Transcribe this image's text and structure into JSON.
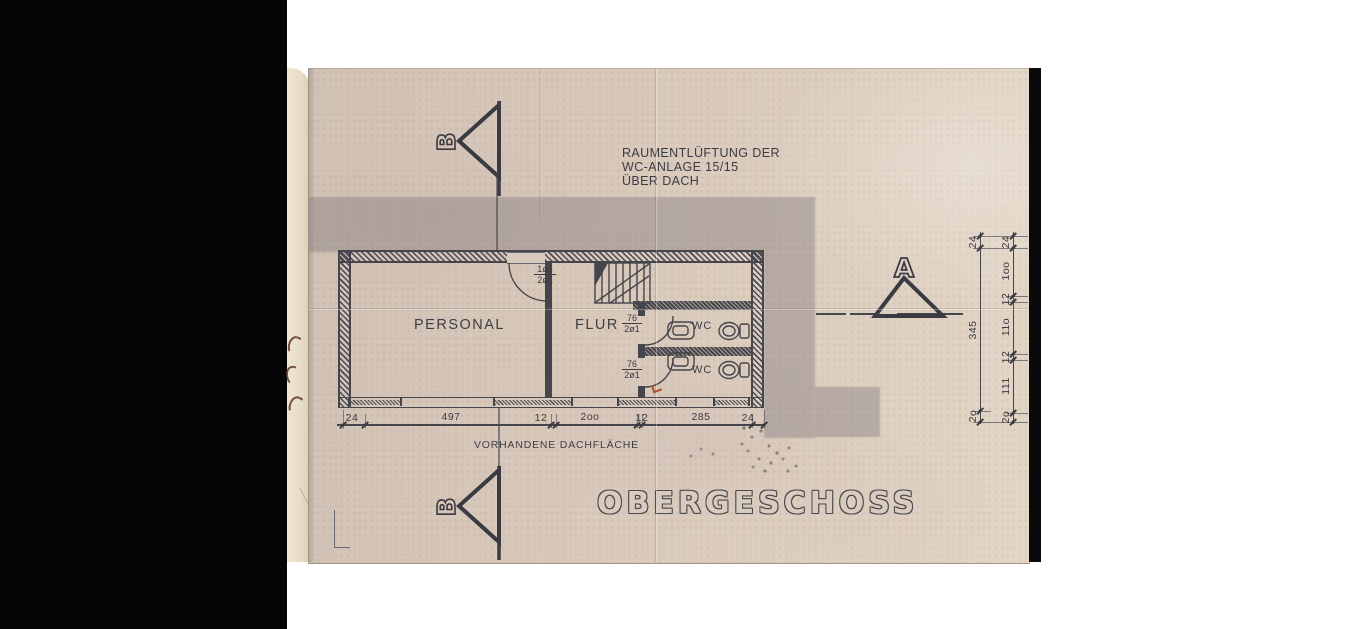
{
  "drawing": {
    "note_lines": [
      "RAUMENTLÜFTUNG DER",
      "WC-ANLAGE 15/15",
      "ÜBER DACH"
    ],
    "title": "OBERGESCHOSS",
    "roof_note": "VORHANDENE DACHFLÄCHE",
    "rooms": {
      "left": "PERSONAL",
      "corridor": "FLUR",
      "wc_upper": "WC",
      "wc_lower": "WC"
    },
    "door_tags": {
      "hall_top": "1ø1",
      "hall_bottom": "2ø1",
      "wc_top": "76",
      "wc_bottom": "2ø1"
    },
    "section_markers": {
      "b": "B",
      "a": "A"
    },
    "dims": {
      "bottom": [
        "24",
        "497",
        "12",
        "2oo",
        "12",
        "285",
        "24"
      ],
      "right_inner": [
        "24",
        "345",
        "2o"
      ],
      "right_outer": [
        "24",
        "1oo",
        "12",
        "11o",
        "12",
        "111",
        "2o"
      ]
    },
    "colors": {
      "paper": "#d8c8ba",
      "underlay": "#eae0c9",
      "ink": "#45454c",
      "roof_shading": "rgba(126,117,123,0.40)",
      "scan_edge": "#000000"
    }
  }
}
